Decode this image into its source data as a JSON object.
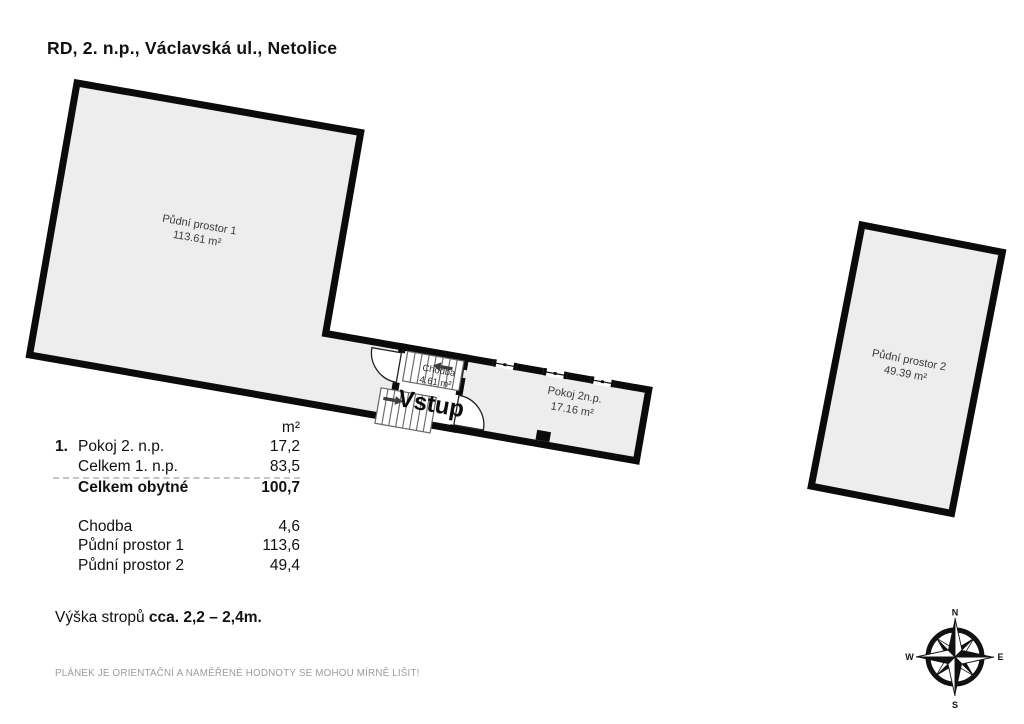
{
  "title": "RD, 2. n.p., Václavská ul., Netolice",
  "plan": {
    "attic1": {
      "name": "Půdní prostor 1",
      "area": "113.61 m²"
    },
    "hallway": {
      "name": "Chodba",
      "area": "4.61 m²"
    },
    "entrance_label": "Vstup",
    "room2": {
      "name": "Pokoj 2n.p.",
      "area": "17.16 m²"
    },
    "attic2": {
      "name": "Půdní prostor 2",
      "area": "49.39 m²"
    }
  },
  "legend": {
    "unit_header": "m²",
    "rows": [
      {
        "num": "1.",
        "label": "Pokoj 2. n.p.",
        "value": "17,2"
      },
      {
        "num": "",
        "label": "Celkem 1. n.p.",
        "value": "83,5"
      },
      {
        "num": "",
        "label": "Celkem obytné",
        "value": "100,7"
      },
      {
        "num": "",
        "label": "Chodba",
        "value": "4,6"
      },
      {
        "num": "",
        "label": "Půdní prostor 1",
        "value": "113,6"
      },
      {
        "num": "",
        "label": "Půdní prostor 2",
        "value": "49,4"
      }
    ]
  },
  "ceiling_note": {
    "prefix": "Výška stropů ",
    "value": "cca. 2,2 – 2,4m."
  },
  "disclaimer": "PLÁNEK JE ORIENTAČNÍ A NAMĚŘENÉ HODNOTY SE MOHOU MÍRNĚ LIŠIT!",
  "compass": {
    "north": "N",
    "east": "E",
    "south": "S",
    "west": "W"
  },
  "colors": {
    "wall": "#0b0b0b",
    "room_fill": "#ededed",
    "room_text": "#3a3a3a"
  }
}
